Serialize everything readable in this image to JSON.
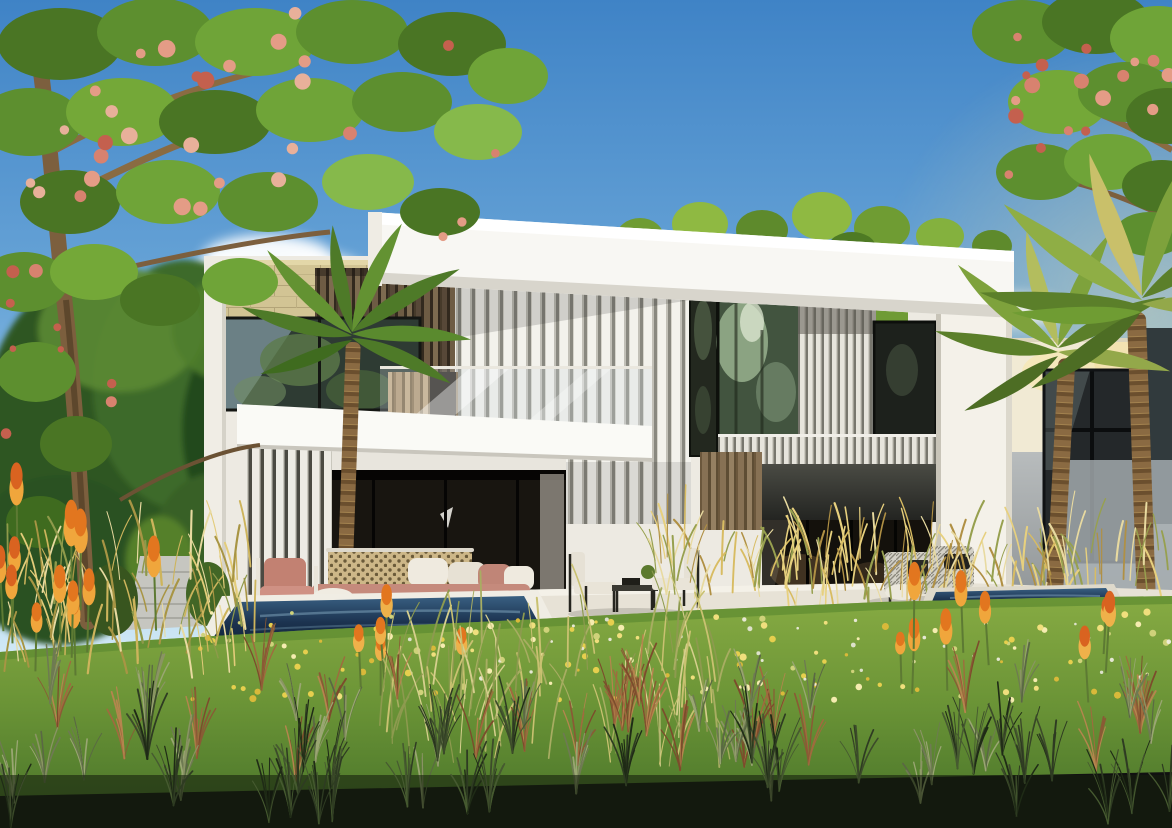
{
  "scene": {
    "kind": "architectural-exterior-rendering",
    "title": "Modern twin villa with garden and plunge pools",
    "time_of_day": "sunny day",
    "elements": [
      "sky",
      "clouds",
      "flowering-tree-left",
      "flowering-tree-right",
      "palm-trees",
      "twin-villa",
      "stone-accent-wall",
      "wood-slat-panels",
      "white-louver-screens",
      "glass-walls",
      "terrace",
      "outdoor-sofa",
      "lounge-chairs",
      "plunge-pool-left",
      "plunge-pool-right",
      "lawn-with-wildflowers",
      "ornamental-grasses",
      "torch-lily-flowers",
      "garden-path",
      "neighbor-wall"
    ]
  },
  "colors": {
    "sky_top": "#3f83c6",
    "sky_mid": "#6aa6d8",
    "sky_low": "#a9d2ec",
    "sky_horizon": "#d9edf8",
    "cloud": "#ffffff",
    "villa_white": "#efede6",
    "fascia_white": "#f8f7f3",
    "stone": "#d2c494",
    "wood_dark": "#5d4d39",
    "wood_tan": "#b49771",
    "charcoal": "#3a3b37",
    "glass_dark": "#1c1a14",
    "glass_reflection": "#42543f",
    "pool_water": "#1c3350",
    "lawn_light": "#87ab43",
    "lawn_dark": "#4f7a2c",
    "sofa_terracotta": "#c08577",
    "pillow_white": "#efeadf",
    "grass_gold": "#d8bc62",
    "lily_orange": "#e2761f",
    "tree_green": "#5d8f2f",
    "tree_flower_red": "#d8826f",
    "palm_green": "#6f9c33",
    "neighbor_grey": "#a9adaf"
  },
  "scatters": [
    {
      "id": "sc-canopy-left-flowers",
      "type": "dot",
      "count": 30,
      "region": [
        14,
        500,
        8,
        240
      ],
      "size": [
        4,
        9
      ],
      "colors": [
        "#d8826f",
        "#e49c86",
        "#c4604e",
        "#e8b09a"
      ],
      "seed": 3
    },
    {
      "id": "sc-canopy-left-flowers2",
      "type": "dot",
      "count": 9,
      "region": [
        0,
        150,
        250,
        470
      ],
      "size": [
        3,
        7
      ],
      "colors": [
        "#d8826f",
        "#c4604e"
      ],
      "seed": 9
    },
    {
      "id": "sc-canopy-right-flowers",
      "type": "dot",
      "count": 18,
      "region": [
        1000,
        1172,
        6,
        200
      ],
      "size": [
        4,
        8
      ],
      "colors": [
        "#d8826f",
        "#e49c86",
        "#c4604e"
      ],
      "seed": 5
    },
    {
      "id": "sc-wildflowers-yellow",
      "type": "dot",
      "count": 130,
      "region": [
        185,
        1172,
        612,
        700
      ],
      "size": [
        1.5,
        3.6
      ],
      "colors": [
        "#e6cf4e",
        "#f0df7d",
        "#d9b93a",
        "#f5ecb0",
        "#cfd27a"
      ],
      "seed": 7
    },
    {
      "id": "sc-wildflowers-white",
      "type": "dot",
      "count": 34,
      "region": [
        380,
        1172,
        612,
        688
      ],
      "size": [
        1.2,
        2.6
      ],
      "colors": [
        "#f2f0e4",
        "#e8e8da"
      ],
      "seed": 21,
      "opacity": 0.9
    },
    {
      "id": "sc-gold-right",
      "type": "blade",
      "count": 150,
      "region": [
        655,
        1168,
        548,
        616
      ],
      "height": [
        26,
        64
      ],
      "lean": 20,
      "width": [
        1,
        2.2
      ],
      "colors": [
        "#d8bc62",
        "#e7d07e",
        "#b09044",
        "#97a04f",
        "#e8daa0"
      ],
      "seed": 11
    },
    {
      "id": "sc-gold-left",
      "type": "blade",
      "count": 90,
      "region": [
        0,
        255,
        562,
        678
      ],
      "height": [
        28,
        70
      ],
      "lean": 22,
      "width": [
        1,
        2.4
      ],
      "colors": [
        "#cdb45c",
        "#e3cc7a",
        "#a89544",
        "#8f9a4b",
        "#e8daa0"
      ],
      "seed": 13
    },
    {
      "id": "sc-lilies-left",
      "type": "spike",
      "count": 8,
      "region": [
        34,
        205,
        600,
        692
      ],
      "height": [
        46,
        86
      ],
      "colors": [
        "#e2761f",
        "#f0a63c",
        "#5d7a33"
      ],
      "seed": 17
    },
    {
      "id": "sc-lilies-farleft",
      "type": "spike",
      "count": 4,
      "region": [
        0,
        72,
        560,
        646
      ],
      "height": [
        50,
        80
      ],
      "colors": [
        "#d96320",
        "#f0a63c",
        "#5d7a33"
      ],
      "seed": 19
    },
    {
      "id": "sc-lilies-mid",
      "type": "spike",
      "count": 5,
      "region": [
        348,
        505,
        636,
        702
      ],
      "height": [
        40,
        72
      ],
      "colors": [
        "#e2761f",
        "#efb14a",
        "#5d7a33"
      ],
      "seed": 23
    },
    {
      "id": "sc-lilies-right",
      "type": "spike",
      "count": 6,
      "region": [
        885,
        995,
        632,
        700
      ],
      "height": [
        38,
        68
      ],
      "colors": [
        "#e2761f",
        "#f0a63c",
        "#5d7a33"
      ],
      "seed": 29
    },
    {
      "id": "sc-lilies-rightedge",
      "type": "spike",
      "count": 3,
      "region": [
        1085,
        1160,
        648,
        716
      ],
      "height": [
        42,
        66
      ],
      "colors": [
        "#d96320",
        "#efb14a",
        "#5d7a33"
      ],
      "seed": 31
    },
    {
      "id": "sc-center-blades",
      "type": "blade",
      "count": 90,
      "region": [
        360,
        740,
        640,
        768
      ],
      "height": [
        40,
        95
      ],
      "lean": 26,
      "width": [
        1,
        2
      ],
      "colors": [
        "#c9c171",
        "#a8ad62",
        "#8d9a4f",
        "#d6cf8d"
      ],
      "seed": 37
    },
    {
      "id": "sc-tuft-red",
      "type": "tuft",
      "count": 24,
      "region": [
        0,
        1172,
        686,
        782
      ],
      "height": [
        34,
        72
      ],
      "lean": 20,
      "blades": [
        6,
        10
      ],
      "colors": [
        "#8a5a35",
        "#a06a3e",
        "#b5854e",
        "#7c4c2c"
      ],
      "seed": 41
    },
    {
      "id": "sc-tuft-sage",
      "type": "tuft",
      "count": 28,
      "region": [
        0,
        1172,
        700,
        812
      ],
      "height": [
        30,
        64
      ],
      "lean": 18,
      "blades": [
        5,
        9
      ],
      "colors": [
        "#6e7a52",
        "#8a9464",
        "#5a6844",
        "#9aa673"
      ],
      "seed": 43
    },
    {
      "id": "sc-tuft-dark",
      "type": "tuft",
      "count": 30,
      "region": [
        0,
        1172,
        752,
        828
      ],
      "height": [
        34,
        78
      ],
      "lean": 22,
      "blades": [
        6,
        11
      ],
      "colors": [
        "#2e3b22",
        "#3c4b2a",
        "#1f2b16",
        "#465a30"
      ],
      "seed": 47
    }
  ]
}
